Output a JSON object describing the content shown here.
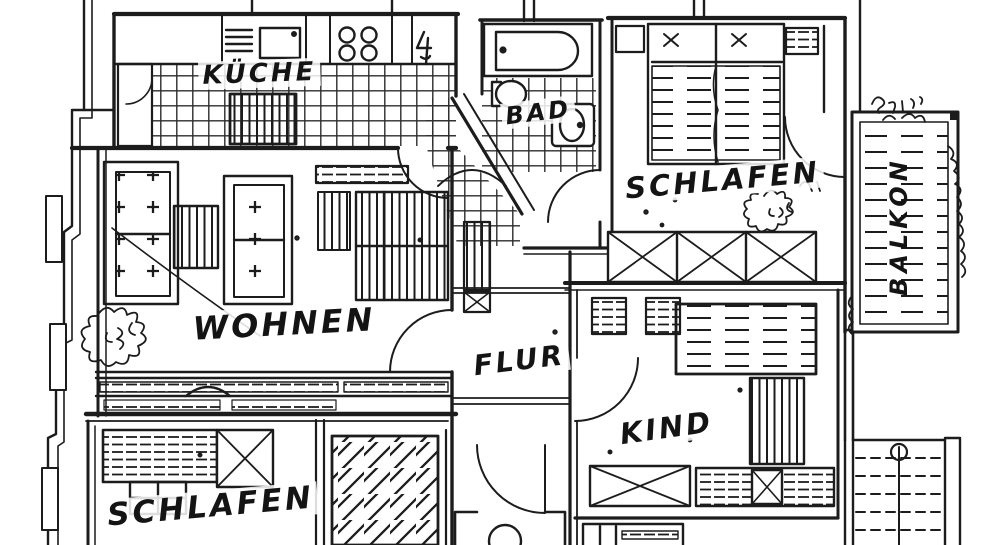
{
  "document": {
    "type": "scanned-floor-plan",
    "style": "hand-drawn black ink on white paper"
  },
  "colors": {
    "ink": "#1c1c1c",
    "paper": "#ffffff"
  },
  "rooms": {
    "kueche": {
      "label": "KÜCHE"
    },
    "bad": {
      "label": "BAD"
    },
    "schlafen_top": {
      "label": "SCHLAFEN"
    },
    "balkon": {
      "label": "BALKON"
    },
    "wohnen": {
      "label": "WOHNEN"
    },
    "flur": {
      "label": "FLUR"
    },
    "kind": {
      "label": "KIND"
    },
    "schlafen_bottom": {
      "label": "SCHLAFEN"
    }
  }
}
